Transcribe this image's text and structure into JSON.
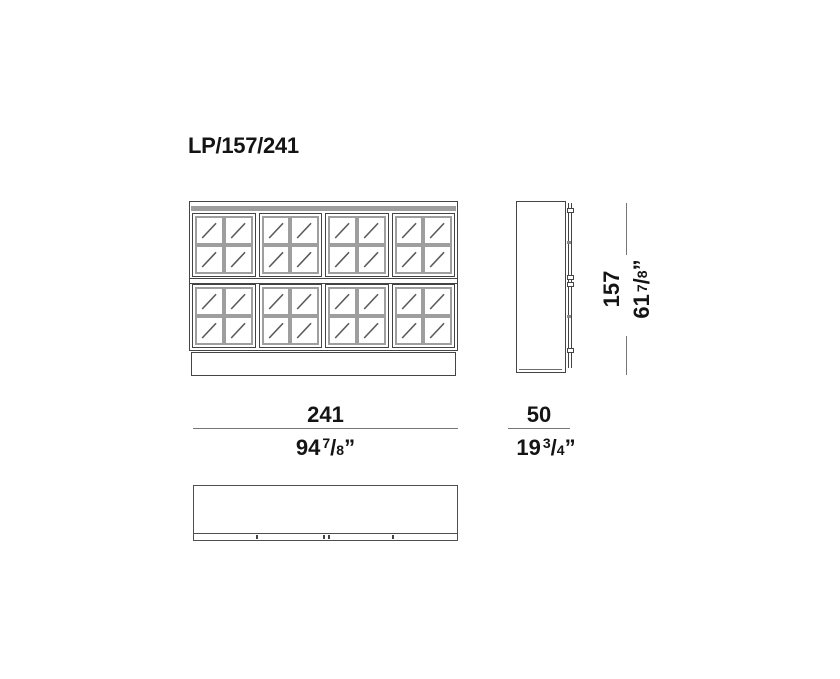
{
  "title": "LP/157/241",
  "structure": {
    "sections": 2,
    "doors_per_section": 4,
    "pane_rows": 2,
    "pane_cols": 2
  },
  "dimensions": {
    "width": {
      "cm": "241",
      "in_whole": "94",
      "in_num": "7",
      "in_den": "8",
      "in_unit": "”"
    },
    "depth": {
      "cm": "50",
      "in_whole": "19",
      "in_num": "3",
      "in_den": "4",
      "in_unit": "”"
    },
    "height": {
      "cm": "157",
      "in_whole": "61",
      "in_num": "7",
      "in_den": "8",
      "in_unit": "”"
    }
  },
  "colors": {
    "outline": "#444444",
    "mullion": "#9e9e9e",
    "reflection": "#5a5a5a",
    "dimension_line": "#757575",
    "text": "#141414"
  }
}
